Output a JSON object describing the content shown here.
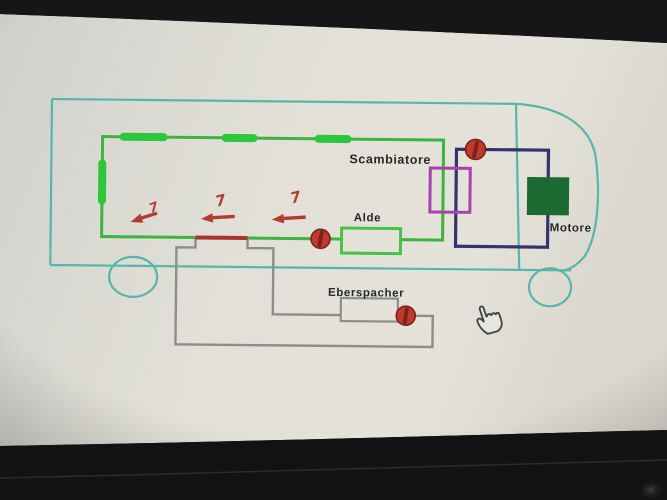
{
  "screen": {
    "background_tint": "#e3e1d8"
  },
  "diagram": {
    "labels": {
      "scambiatore": "Scambiatore",
      "alde": "Alde",
      "eberspacher": "Eberspacher",
      "motore": "Motore"
    },
    "flow_arrows": [
      "7",
      "7",
      "7"
    ],
    "colors": {
      "vehicle_outline": "#57b6ab",
      "heating_loop": "#3cb440",
      "radiator": "#2fc73a",
      "alde_box": "#4ac04a",
      "hot_section": "#a8352c",
      "engine_loop": "#34336e",
      "heat_exchanger": "#a643b2",
      "engine_block": "#1b6b30",
      "eberspacher_circuit": "#8d8d8d",
      "pump": "#c03a2d",
      "pump_dark": "#7f241c",
      "arrow": "#b23a32",
      "label_text": "#26262e"
    },
    "icons": {
      "pump": "circle-with-impeller",
      "cursor": "hand-pointer"
    }
  }
}
